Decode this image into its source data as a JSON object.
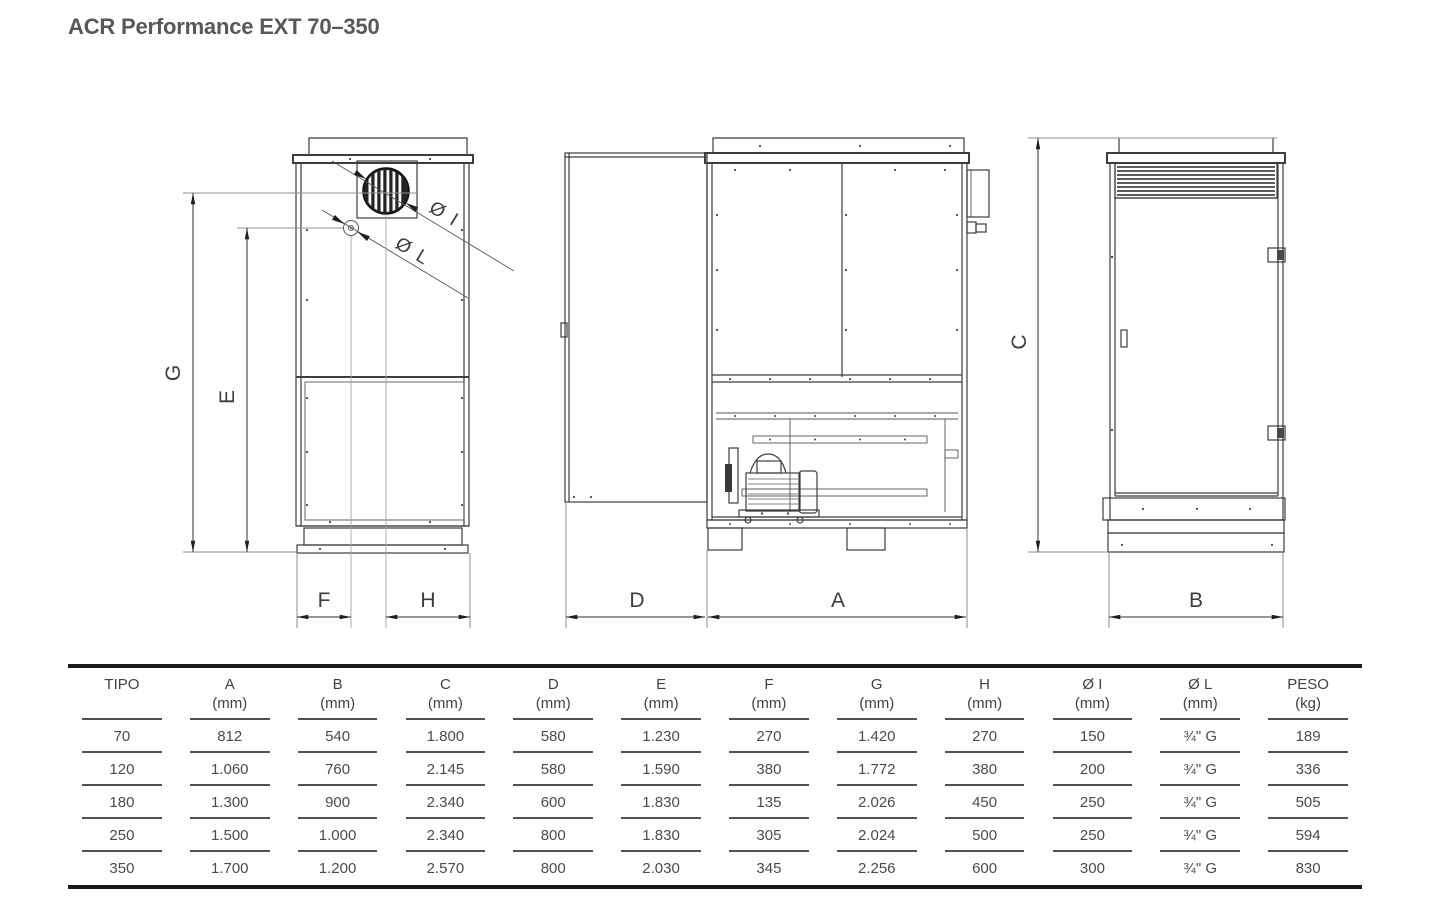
{
  "page": {
    "title": "ACR Performance EXT 70–350"
  },
  "drawing": {
    "dims": {
      "G": "G",
      "E": "E",
      "F": "F",
      "H": "H",
      "D": "D",
      "A": "A",
      "C": "C",
      "B": "B",
      "I": "Ø I",
      "L": "Ø L"
    }
  },
  "table": {
    "columns": [
      {
        "label": "TIPO",
        "unit": ""
      },
      {
        "label": "A",
        "unit": "(mm)"
      },
      {
        "label": "B",
        "unit": "(mm)"
      },
      {
        "label": "C",
        "unit": "(mm)"
      },
      {
        "label": "D",
        "unit": "(mm)"
      },
      {
        "label": "E",
        "unit": "(mm)"
      },
      {
        "label": "F",
        "unit": "(mm)"
      },
      {
        "label": "G",
        "unit": "(mm)"
      },
      {
        "label": "H",
        "unit": "(mm)"
      },
      {
        "label": "Ø I",
        "unit": "(mm)"
      },
      {
        "label": "Ø L",
        "unit": "(mm)"
      },
      {
        "label": "PESO",
        "unit": "(kg)"
      }
    ],
    "rows": [
      [
        "70",
        "812",
        "540",
        "1.800",
        "580",
        "1.230",
        "270",
        "1.420",
        "270",
        "150",
        "¾\" G",
        "189"
      ],
      [
        "120",
        "1.060",
        "760",
        "2.145",
        "580",
        "1.590",
        "380",
        "1.772",
        "380",
        "200",
        "¾\" G",
        "336"
      ],
      [
        "180",
        "1.300",
        "900",
        "2.340",
        "600",
        "1.830",
        "135",
        "2.026",
        "450",
        "250",
        "¾\" G",
        "505"
      ],
      [
        "250",
        "1.500",
        "1.000",
        "2.340",
        "800",
        "1.830",
        "305",
        "2.024",
        "500",
        "250",
        "¾\" G",
        "594"
      ],
      [
        "350",
        "1.700",
        "1.200",
        "2.570",
        "800",
        "2.030",
        "345",
        "2.256",
        "600",
        "300",
        "¾\" G",
        "830"
      ]
    ]
  }
}
